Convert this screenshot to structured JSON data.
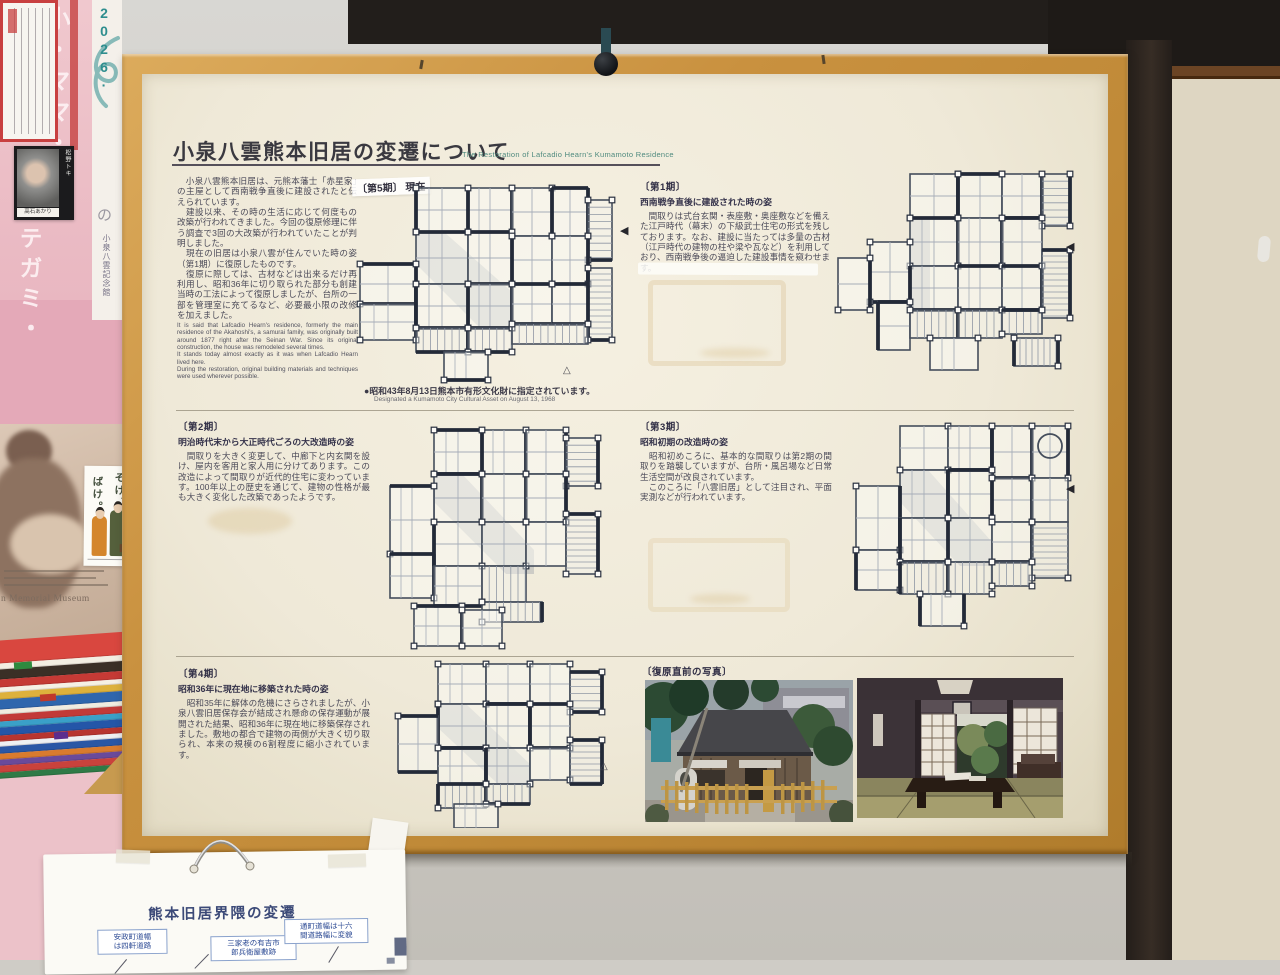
{
  "poster": {
    "title": "小泉八雲熊本旧居の変遷について",
    "subtitle_en": "The Restoration of Lafcadio Hearn's Kumamoto Residence",
    "intro_jp": "　小泉八雲熊本旧居は、元熊本藩士「赤星家」の主屋として西南戦争直後に建設されたと伝えられています。\n　建設以来、その時の生活に応じて何度もの改築が行われてきました。今回の復原修理に伴う調査で3回の大改築が行われていたことが判明しました。\n　現在の旧居は小泉八雲が住んでいた時の姿（第1期）に復原したものです。\n　復原に際しては、古材などは出来るだけ再利用し、昭和36年に切り取られた部分も創建当時の工法によって復原しましたが、台所の一部を管理室に充てるなど、必要最小限の改修を加えました。",
    "intro_en": "It is said that Lafcadio Hearn's residence, formerly the main residence of the Akahoshi's, a samurai family, was originally built around 1877 right after the Seinan War. Since its original construction, the house was remodeled several times.\nIt stands today almost exactly as it was when Lafcadio Hearn lived here.\nDuring the restoration, original building materials and techniques were used wherever possible.",
    "plan_current_label": "〔第5期〕 現在",
    "designation_jp": "●昭和43年8月13日熊本市有形文化財に指定されています。",
    "designation_en": "Designated a Kumamoto City Cultural Asset on August 13, 1968",
    "sections": [
      {
        "label": "〔第1期〕",
        "heading": "西南戦争直後に建設された時の姿",
        "body": "　間取りは式台玄関・表座敷・奥座敷などを備えた江戸時代（幕末）の下級武士住宅の形式を残しております。なお、建設に当たっては多量の古材（江戸時代の建物の柱や梁や瓦など）を利用しており、西南戦争後の逼迫した建設事情を窺わせます。"
      },
      {
        "label": "〔第2期〕",
        "heading": "明治時代末から大正時代ごろの大改造時の姿",
        "body": "　間取りを大きく変更して、中廊下と内玄関を設け、屋内を客用と家人用に分けてあります。この改造によって間取りが近代的住宅に変わっています。100年以上の歴史を通じて、建物の性格が最も大きく変化した改築であったようです。"
      },
      {
        "label": "〔第3期〕",
        "heading": "昭和初期の改造時の姿",
        "body": "　昭和初めころに、基本的な間取りは第2期の間取りを踏襲していますが、台所・風呂場など日常生活空間が改良されています。\n　このころに「八雲旧居」として注目され、平面実測などが行われています。"
      },
      {
        "label": "〔第4期〕",
        "heading": "昭和36年に現在地に移築された時の姿",
        "body": "　昭和35年に解体の危機にさらされましたが、小泉八雲旧居保存会が結成され懸命の保存運動が展開された結果、昭和36年に現在地に移築保存されました。敷地の都合で建物の両側が大きく切り取られ、本来の規模の6割程度に縮小されています。"
      }
    ],
    "photos_label": "〔復原直前の写真〕",
    "marker_filled": "◀",
    "marker_hollow": "△"
  },
  "side": {
    "year": "2026·",
    "word_top": "小・ママ・",
    "word_bottom": "テガミ・",
    "particle": "の",
    "museum_vertical": "小泉八雲記念館",
    "photo_tag": "松野トキ",
    "photo_name": "髙石あかり",
    "bake_right": "そげ、",
    "bake_left": "ばけ。",
    "museum_en": "n Memorial Museum"
  },
  "sheet": {
    "title": "熊本旧居界隈の変遷",
    "notes": [
      "安政町道幅\nは四軒道路",
      "三家老の有吉市\n郎兵衛屋敷跡",
      "通町道幅は十六\n間道路幅に変貌"
    ]
  }
}
